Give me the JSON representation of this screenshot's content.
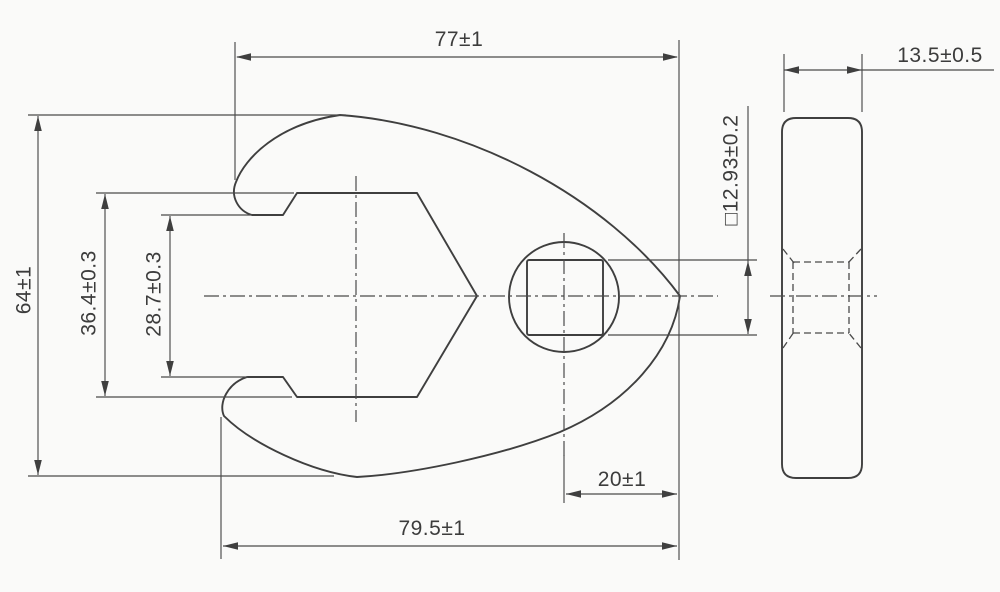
{
  "drawing": {
    "kind": "technical-drawing",
    "subject": "crowfoot-wrench-two-views",
    "colors": {
      "line": "#3f3f3f",
      "background": "#fafaf9"
    },
    "labels": {
      "width_top": "77±1",
      "side_thickness": "13.5±0.5",
      "square_drive": "□12.93±0.2",
      "overall_height": "64±1",
      "jaw_outer_flats": "36.4±0.3",
      "jaw_opening": "28.7±0.3",
      "drive_to_edge": "20±1",
      "overall_length": "79.5±1"
    }
  }
}
